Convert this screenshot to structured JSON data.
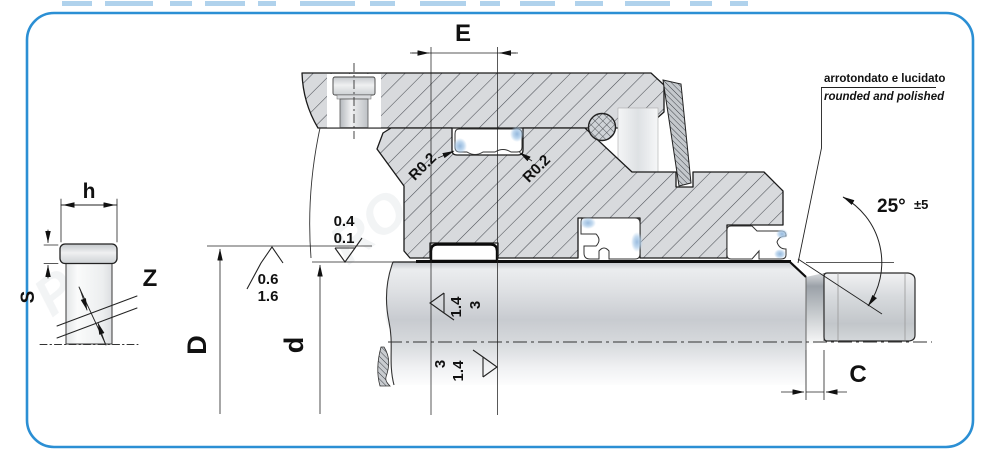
{
  "frame": {
    "border_color": "#2b8fd4"
  },
  "watermark": {
    "fragments": [
      "PR",
      "RO",
      "OM",
      "N"
    ]
  },
  "left_view": {
    "width_label": "h",
    "thickness_label": "S",
    "gap_label": "Z"
  },
  "main_view": {
    "groove_width_label": "E",
    "bore_diameter_label": "D",
    "rod_diameter_label": "d",
    "chamfer_length_label": "C",
    "radius_left": "R0.2",
    "radius_right": "R0.2",
    "angle_value": "25°",
    "angle_tolerance": "±5",
    "note_italian": "arrotondato e lucidato",
    "note_english": "rounded and polished",
    "roughness_groove_face": {
      "top": "0.4",
      "bottom": "0.1"
    },
    "roughness_bore": {
      "top": "0.6",
      "bottom": "1.6"
    },
    "roughness_rod_above": {
      "first": "1.4",
      "second": "3"
    },
    "roughness_rod_below": {
      "first": "3",
      "second": "1.4"
    }
  },
  "colors": {
    "metal_fill": "#d8dadd",
    "hatch_line": "#4a4e54",
    "outline": "#1a1a1a",
    "seal_shade_blue": "#7ba7d4"
  }
}
